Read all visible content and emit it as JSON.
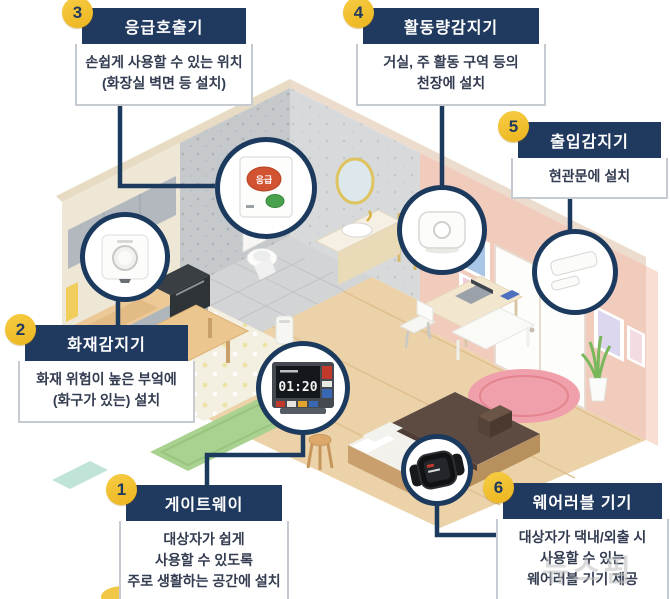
{
  "watermark": {
    "text": "뉴스핌"
  },
  "colors": {
    "accent_navy": "#20395f",
    "connector_navy": "#1c3a5e",
    "badge_yellow": "#f2c233",
    "box_border": "#c6cad1",
    "wall_pink": "#f1ccbd",
    "bathroom_wall_gray": "#c6c9cc",
    "floor_wood": "#ecd2a8",
    "rug_pink": "#f0a0aa",
    "mat_green": "#a9d18f",
    "emergency_red": "#d15331",
    "emergency_green": "#49a14d"
  },
  "callouts": [
    {
      "number": "1",
      "title": "게이트웨이",
      "lines": [
        "대상자가 쉽게",
        "사용할 수 있도록",
        "주로 생활하는 공간에 설치"
      ]
    },
    {
      "number": "2",
      "title": "화재감지기",
      "lines": [
        "화재 위험이 높은 부엌에",
        "(화구가 있는) 설치"
      ]
    },
    {
      "number": "3",
      "title": "응급호출기",
      "lines": [
        "손쉽게 사용할 수 있는 위치",
        "(화장실 벽면 등 설치)"
      ]
    },
    {
      "number": "4",
      "title": "활동량감지기",
      "lines": [
        "거실, 주 활동 구역 등의",
        "천장에 설치"
      ]
    },
    {
      "number": "5",
      "title": "출입감지기",
      "lines": [
        "현관문에 설치"
      ]
    },
    {
      "number": "6",
      "title": "웨어러블 기기",
      "lines": [
        "대상자가 댁내/외출 시",
        "사용할 수 있는",
        "웨어러블 기기 제공"
      ]
    }
  ],
  "devices": {
    "gateway": {
      "screen_time": "01:20"
    },
    "emergency": {
      "button_label": "응급"
    }
  },
  "device_icons": [
    "gateway-device-icon",
    "fire-detector-icon",
    "emergency-call-icon",
    "activity-sensor-icon",
    "entry-sensor-icon",
    "wearable-watch-icon"
  ]
}
